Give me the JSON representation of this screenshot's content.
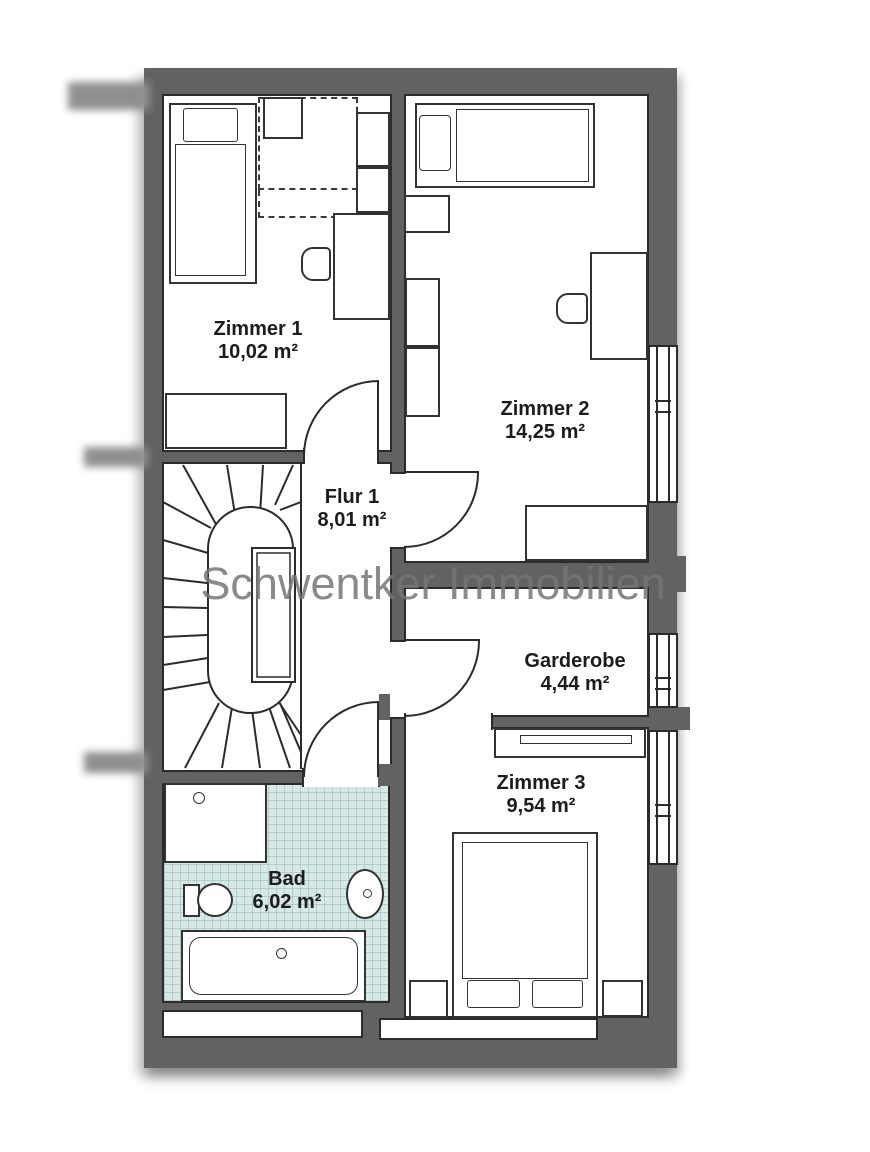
{
  "watermark": "Schwentker Immobilien",
  "rooms": {
    "zimmer1": {
      "name": "Zimmer 1",
      "area": "10,02 m²"
    },
    "zimmer2": {
      "name": "Zimmer 2",
      "area": "14,25 m²"
    },
    "flur1": {
      "name": "Flur 1",
      "area": "8,01 m²"
    },
    "garderobe": {
      "name": "Garderobe",
      "area": "4,44 m²"
    },
    "zimmer3": {
      "name": "Zimmer 3",
      "area": "9,54 m²"
    },
    "bad": {
      "name": "Bad",
      "area": "6,02 m²"
    }
  },
  "colors": {
    "wall": "#626262",
    "line": "#2b2b2b",
    "bath_tile": "#d8e8e7",
    "watermark": "#8f8f8f",
    "background": "#ffffff"
  }
}
